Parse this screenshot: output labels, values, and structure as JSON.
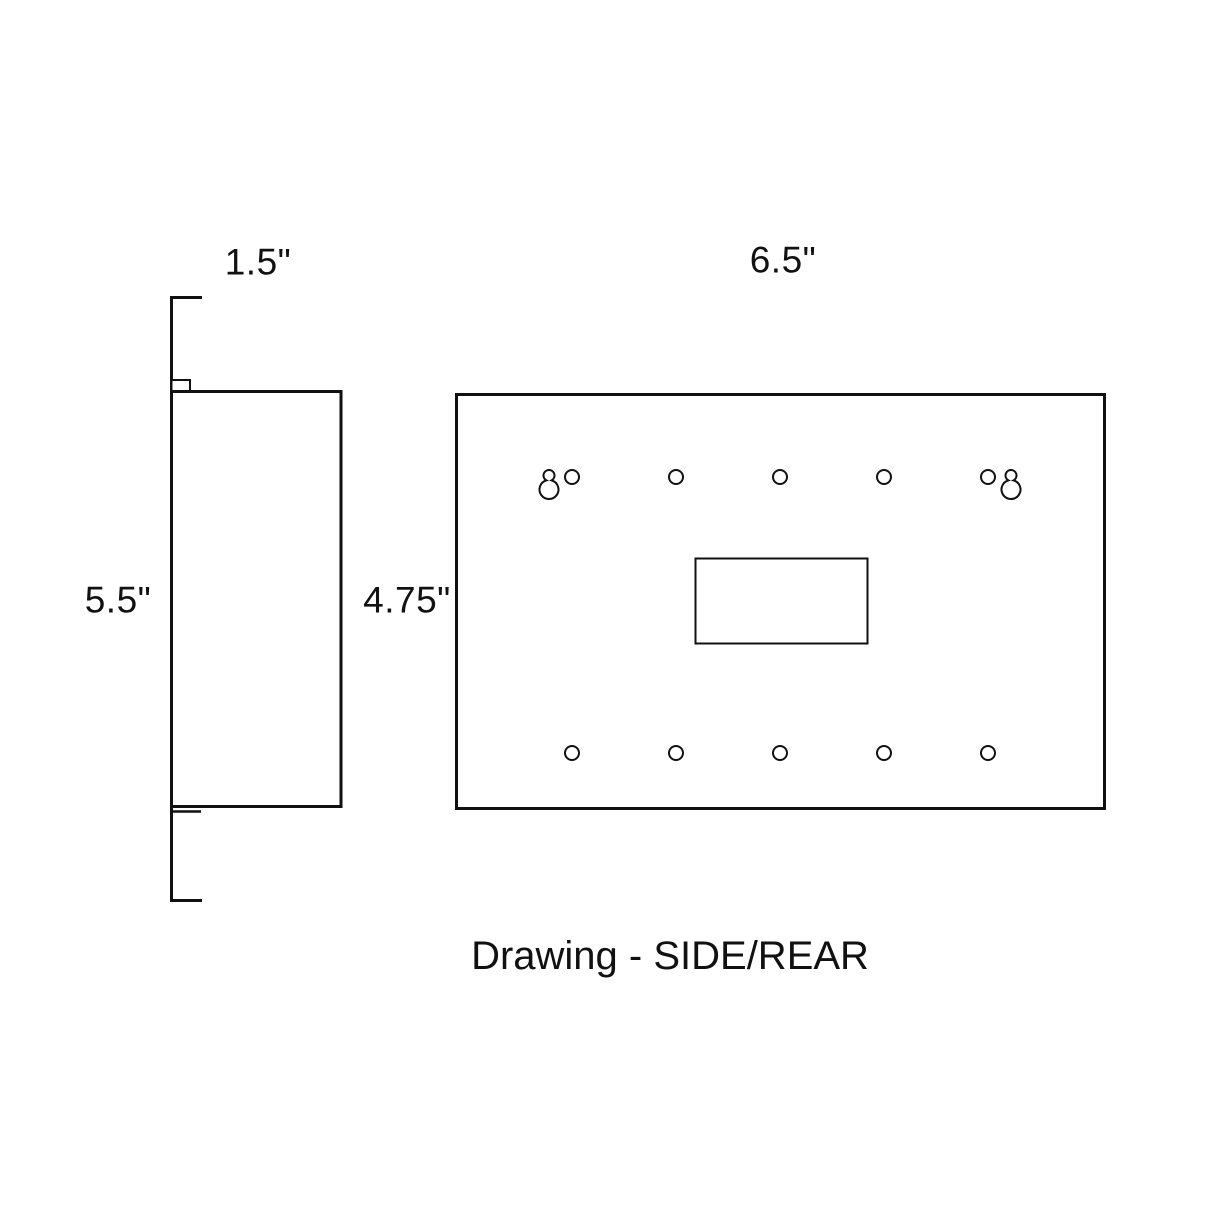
{
  "page": {
    "colors": {
      "background": "#ffffff",
      "ink": "#111111"
    }
  },
  "drawing": {
    "caption": "Drawing - SIDE/REAR",
    "side_view": {
      "depth_label": "1.5\"",
      "height_label": "5.5\""
    },
    "rear_view": {
      "width_label": "6.5\"",
      "height_label": "4.75\""
    }
  }
}
